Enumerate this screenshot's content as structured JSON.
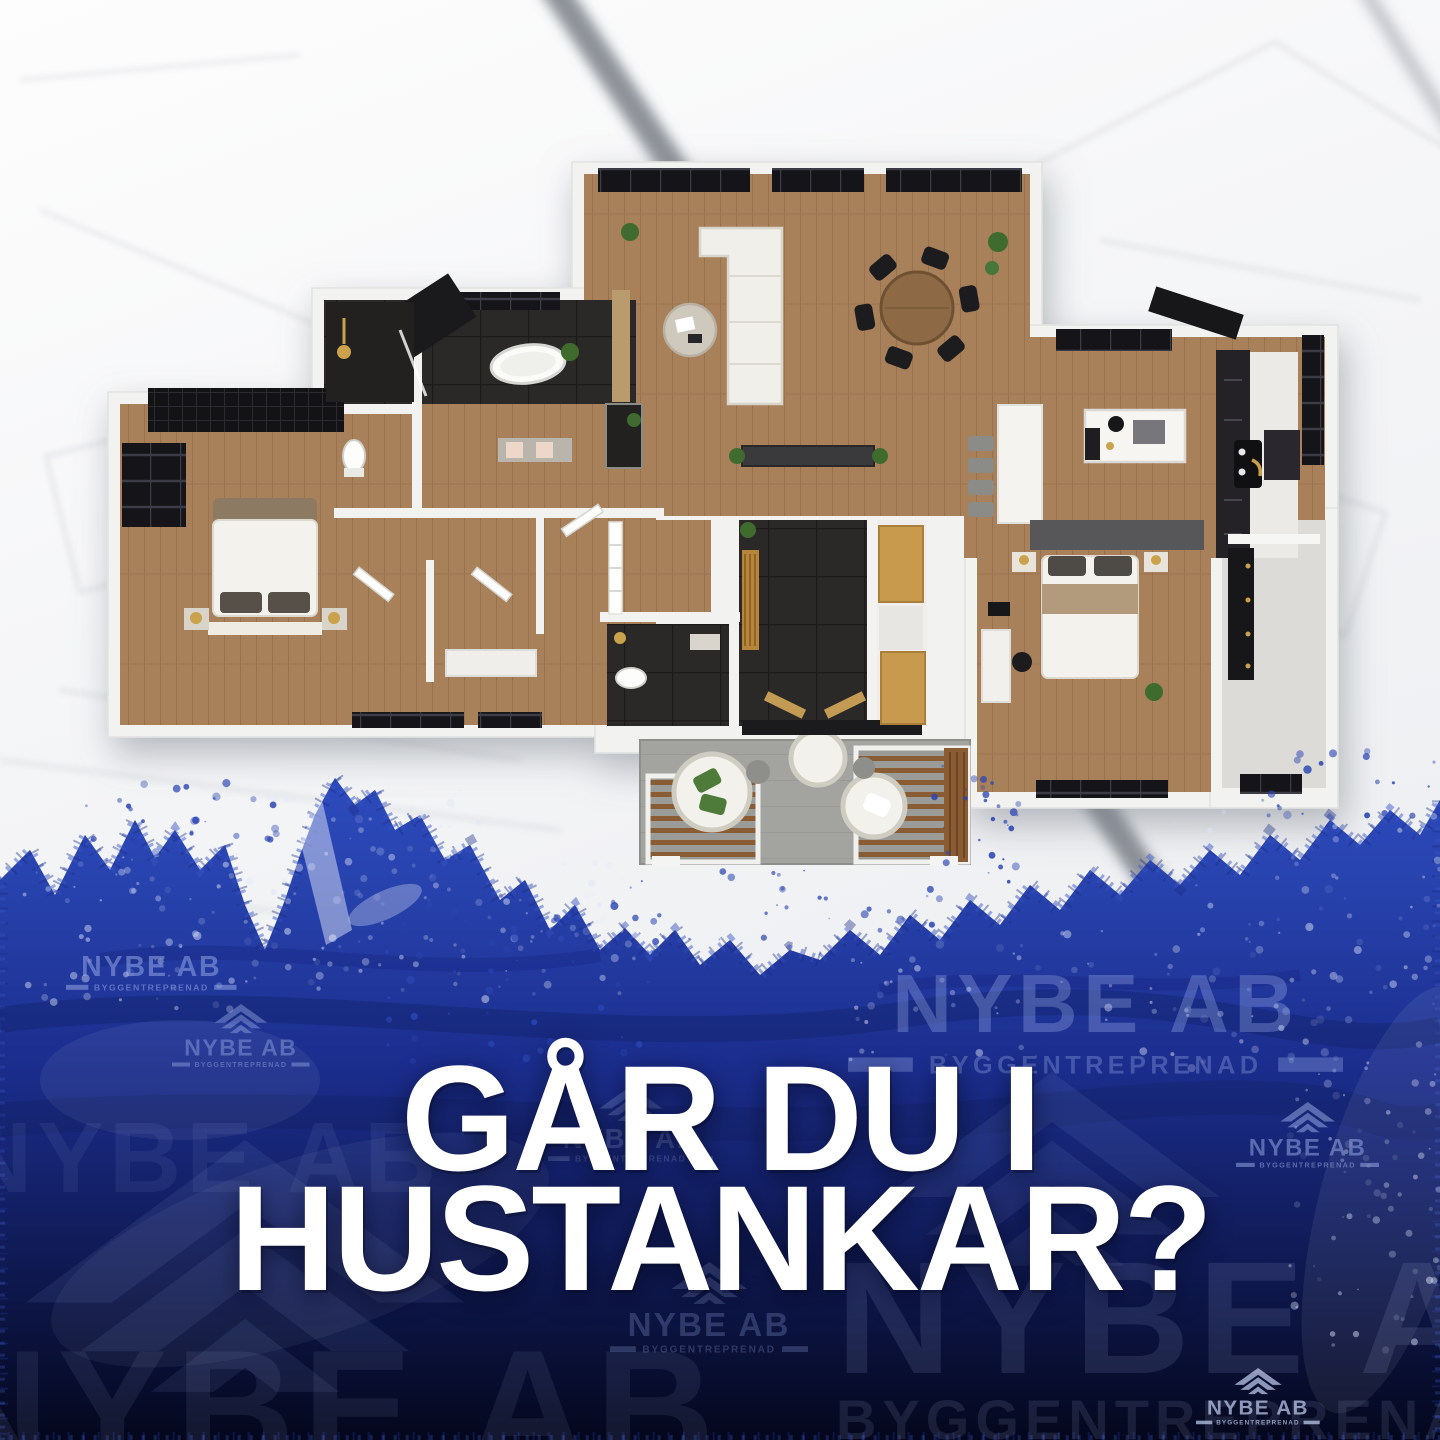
{
  "poster": {
    "headline": {
      "line1": "GÅR DU I",
      "line2": "HUSTANKAR?"
    },
    "brand": {
      "company": "NYBE AB",
      "tagline": "BYGGENTREPRENAD",
      "logo_icon": "roof-chevrons-icon"
    },
    "colors": {
      "brush_blue": "#2b47b5",
      "navy_deep": "#070b1e",
      "headline_white": "#ffffff",
      "watermark_blue": "#9db0ea",
      "floor_wood": "#a8805a",
      "tile_dark": "#2b2927",
      "wall_white": "#f2f2f0",
      "cabinet_gold": "#c89a4e",
      "patio_concrete": "#a3a3a0"
    }
  }
}
